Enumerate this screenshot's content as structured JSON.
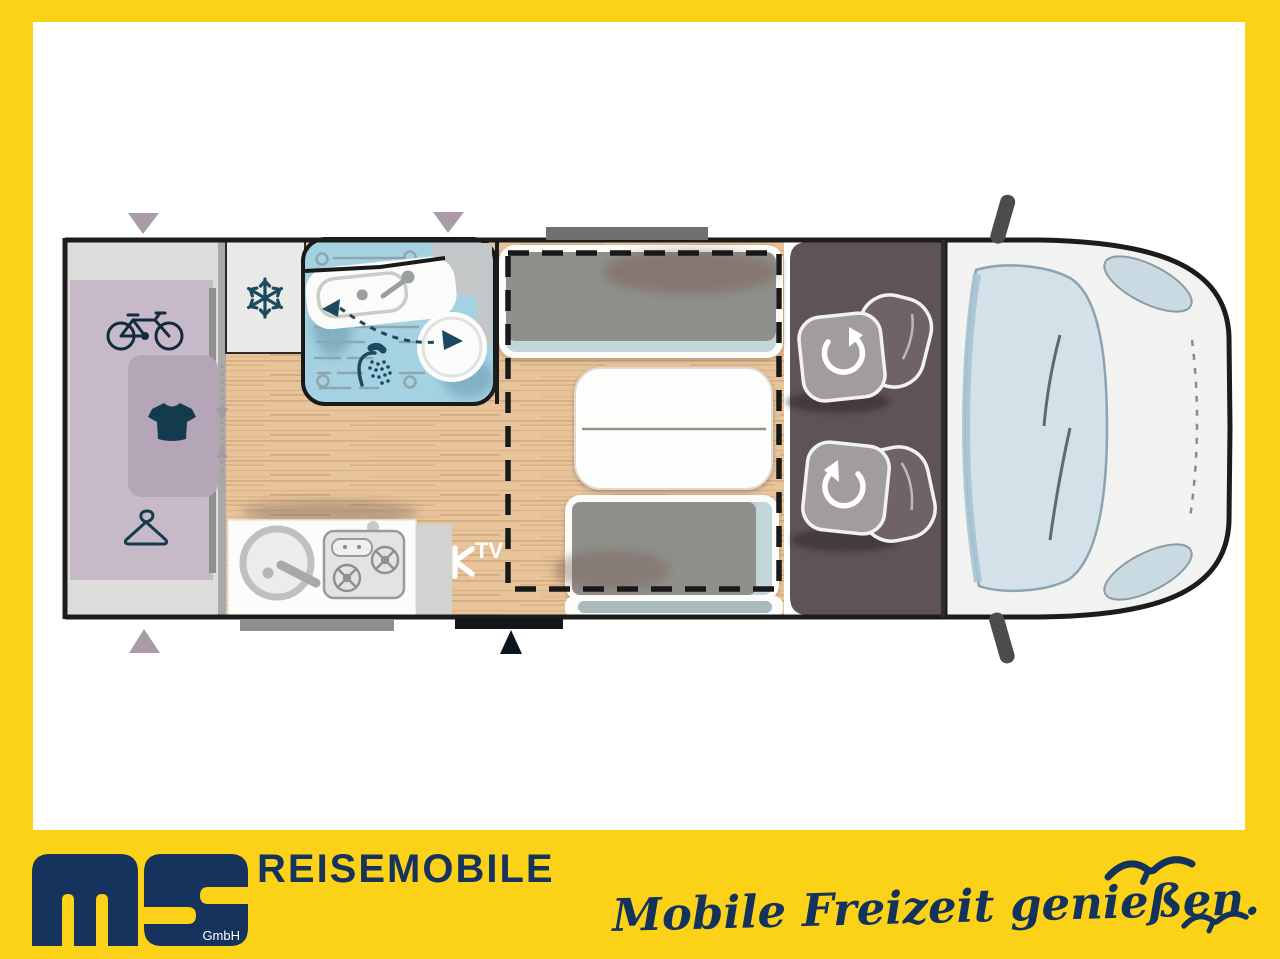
{
  "banner": {
    "company": "REISEMOBILE",
    "company_suffix": "GmbH",
    "slogan": "Mobile Freizeit genießen.",
    "colors": {
      "yellow": "#fbd217",
      "navy": "#16335e"
    }
  },
  "floorplan": {
    "tv_label": "TV",
    "icons": {
      "garage": [
        "bicycle-icon",
        "tshirt-icon",
        "hanger-icon"
      ],
      "fridge": "snowflake-icon",
      "bathroom": [
        "shower-icon",
        "swivel-toilet-arrow"
      ],
      "cab": [
        "swivel-seat-arrow",
        "swivel-seat-arrow"
      ],
      "media": "tv-mount-icon"
    },
    "colors": {
      "wood": "#e8c49b",
      "bathroom_blue": "#a5d2e2",
      "garage_mauve": "#c7b9c8",
      "wardrobe_mauve": "#b4a6b6",
      "cab_dark": "#5e5359",
      "bench_gray": "#8f8f8c",
      "accent_teal": "#c2d6d8",
      "body_white": "#f2f2f0",
      "outline_black": "#1c1c1c",
      "windshield_blue": "#d4e1e8",
      "marker_mauve": "#ab9ba7"
    }
  }
}
